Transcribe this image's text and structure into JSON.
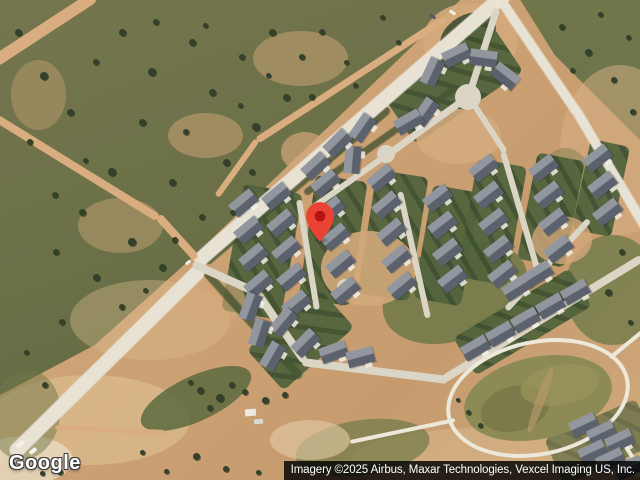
{
  "map": {
    "logo_text": "Google",
    "attribution_text": "Imagery ©2025 Airbus, Maxar Technologies, Vexcel Imaging US, Inc.",
    "pin": {
      "x": 320,
      "y": 242,
      "fill": "#EA4335",
      "dot": "#B31412"
    }
  },
  "palette": {
    "dirt": "#cda376",
    "dirt_light": "#e0bb8e",
    "trail": "#d9ad7f",
    "pale": "#e9dcc2",
    "road": "#e7e2d4",
    "street": "#dbd5c5",
    "path": "#ece8da",
    "scrub": "#6b7047",
    "lawn_a": "#52643c",
    "lawn_b": "#3e5030",
    "hedge": "#455532",
    "roof_dark": "#5b616d",
    "roof_light": "#92979f",
    "pond": "#8c8b56",
    "pond_dark": "#7b7a4a"
  },
  "scene": {
    "base_blobs": [
      {
        "cx": 90,
        "cy": 420,
        "w": 200,
        "h": 90,
        "c": "#e2c496",
        "op": 0.55
      },
      {
        "cx": 500,
        "cy": 462,
        "w": 300,
        "h": 70,
        "c": "#d8b78c",
        "op": 0.5
      },
      {
        "cx": 620,
        "cy": 150,
        "w": 120,
        "h": 170,
        "c": "#dab287",
        "op": 0.5
      },
      {
        "cx": 150,
        "cy": 320,
        "w": 160,
        "h": 80,
        "c": "#d9b88c",
        "op": 0.4
      },
      {
        "cx": 25,
        "cy": 460,
        "w": 95,
        "h": 48,
        "c": "#e9dcc2",
        "op": 0.8
      },
      {
        "cx": 470,
        "cy": 40,
        "w": 95,
        "h": 75,
        "c": "#d4aa7c",
        "op": 0.9
      }
    ],
    "green_mottle": [
      {
        "cx": 300,
        "cy": 58,
        "w": 95,
        "h": 55,
        "c": "#cfa678",
        "op": 0.5
      },
      {
        "cx": 205,
        "cy": 135,
        "w": 75,
        "h": 45,
        "c": "#cfa678",
        "op": 0.5
      },
      {
        "cx": 120,
        "cy": 225,
        "w": 85,
        "h": 55,
        "c": "#cfa678",
        "op": 0.45
      },
      {
        "cx": 38,
        "cy": 95,
        "w": 55,
        "h": 70,
        "c": "#cfa678",
        "op": 0.4
      }
    ],
    "green_blobs": [
      {
        "cx": 455,
        "cy": 292,
        "w": 150,
        "h": 95,
        "rot": -20,
        "c": "#6d7847",
        "op": 0.85
      },
      {
        "cx": 612,
        "cy": 290,
        "w": 95,
        "h": 110,
        "c": "#6f7a4a",
        "op": 0.8
      },
      {
        "cx": 362,
        "cy": 447,
        "w": 135,
        "h": 55,
        "rot": -8,
        "c": "#757c4c",
        "op": 0.75
      },
      {
        "cx": 196,
        "cy": 398,
        "w": 120,
        "h": 45,
        "rot": -25,
        "c": "#5c6a3e",
        "op": 0.85
      },
      {
        "cx": 25,
        "cy": 415,
        "w": 70,
        "h": 90,
        "rot": 10,
        "c": "#6f7749",
        "op": 0.5
      },
      {
        "cx": 565,
        "cy": 185,
        "w": 55,
        "h": 75,
        "c": "#767c4e",
        "op": 0.45
      },
      {
        "cx": 468,
        "cy": 35,
        "w": 60,
        "h": 40,
        "rot": -30,
        "c": "#3f4f31",
        "op": 0.9
      }
    ],
    "sub_dirt": [
      {
        "cx": 368,
        "cy": 268,
        "w": 95,
        "h": 75,
        "c": "#d2a87a",
        "op": 0.9
      },
      {
        "cx": 458,
        "cy": 136,
        "w": 85,
        "h": 55,
        "c": "#d5ac7e",
        "op": 0.85
      },
      {
        "cx": 562,
        "cy": 240,
        "w": 60,
        "h": 48,
        "c": "#d2a87a",
        "op": 0.8
      },
      {
        "cx": 305,
        "cy": 152,
        "w": 48,
        "h": 40,
        "c": "#d2a87a",
        "op": 0.7
      },
      {
        "cx": 210,
        "cy": 300,
        "w": 70,
        "h": 50,
        "c": "#d2a87a",
        "op": 0.6
      },
      {
        "cx": 310,
        "cy": 440,
        "w": 80,
        "h": 40,
        "c": "#e3cba6",
        "op": 0.6
      }
    ],
    "lawns": [
      {
        "cx": 262,
        "cy": 252,
        "w": 60,
        "h": 128,
        "rot": 10
      },
      {
        "cx": 333,
        "cy": 240,
        "w": 52,
        "h": 125,
        "rot": 8
      },
      {
        "cx": 393,
        "cy": 235,
        "w": 52,
        "h": 125,
        "rot": 9
      },
      {
        "cx": 447,
        "cy": 245,
        "w": 48,
        "h": 115,
        "rot": 10
      },
      {
        "cx": 492,
        "cy": 222,
        "w": 50,
        "h": 120,
        "rot": 10
      },
      {
        "cx": 551,
        "cy": 210,
        "w": 48,
        "h": 108,
        "rot": 11
      },
      {
        "cx": 601,
        "cy": 188,
        "w": 40,
        "h": 92,
        "rot": 12
      },
      {
        "cx": 522,
        "cy": 322,
        "w": 135,
        "h": 44,
        "rot": -31
      },
      {
        "cx": 300,
        "cy": 338,
        "w": 95,
        "h": 55,
        "rot": -42
      },
      {
        "cx": 452,
        "cy": 82,
        "w": 130,
        "h": 62,
        "rot": -34
      },
      {
        "cx": 600,
        "cy": 442,
        "w": 100,
        "h": 50,
        "rot": -24,
        "op": 0.65
      }
    ],
    "hedges": [
      {
        "cx": 297,
        "cy": 185,
        "len": 240,
        "w": 9,
        "rot": -40
      },
      {
        "cx": 252,
        "cy": 324,
        "len": 145,
        "w": 8,
        "rot": 48
      },
      {
        "cx": 380,
        "cy": 140,
        "len": 185,
        "w": 7,
        "rot": -35
      }
    ],
    "roads": [
      {
        "x1": 196,
        "y1": 263,
        "x2": 510,
        "y2": -10,
        "w": 14,
        "t": "road"
      },
      {
        "x1": 12,
        "y1": 455,
        "x2": 202,
        "y2": 268,
        "w": 14,
        "t": "road"
      },
      {
        "x1": 497,
        "y1": -6,
        "x2": 577,
        "y2": 112,
        "w": 9,
        "t": "road"
      },
      {
        "x1": 575,
        "y1": 108,
        "x2": 646,
        "y2": 228,
        "w": 9,
        "t": "road"
      },
      {
        "x1": 193,
        "y1": 264,
        "x2": 258,
        "y2": 293,
        "w": 8,
        "t": "street"
      },
      {
        "x1": 256,
        "y1": 291,
        "x2": 305,
        "y2": 362,
        "w": 8,
        "t": "street"
      },
      {
        "x1": 302,
        "y1": 362,
        "x2": 448,
        "y2": 380,
        "w": 8,
        "t": "street"
      },
      {
        "x1": 444,
        "y1": 379,
        "x2": 642,
        "y2": 258,
        "w": 8,
        "t": "street"
      },
      {
        "x1": 299,
        "y1": 200,
        "x2": 317,
        "y2": 310,
        "w": 6,
        "t": "street"
      },
      {
        "x1": 400,
        "y1": 192,
        "x2": 428,
        "y2": 318,
        "w": 6,
        "t": "street"
      },
      {
        "x1": 503,
        "y1": 152,
        "x2": 541,
        "y2": 282,
        "w": 6,
        "t": "street"
      },
      {
        "x1": 589,
        "y1": 220,
        "x2": 506,
        "y2": 310,
        "w": 6,
        "t": "street"
      },
      {
        "x1": 388,
        "y1": 154,
        "x2": 467,
        "y2": 97,
        "w": 7,
        "t": "street"
      },
      {
        "x1": 497,
        "y1": 8,
        "x2": 469,
        "y2": 95,
        "w": 7,
        "t": "street"
      },
      {
        "x1": 312,
        "y1": 208,
        "x2": 388,
        "y2": 154,
        "w": 6,
        "t": "street"
      },
      {
        "x1": 469,
        "y1": 97,
        "x2": 505,
        "y2": 152,
        "w": 6,
        "t": "street"
      },
      {
        "x1": 95,
        "y1": -4,
        "x2": -6,
        "y2": 62,
        "w": 12,
        "t": "trail"
      },
      {
        "x1": -4,
        "y1": 118,
        "x2": 158,
        "y2": 218,
        "w": 8,
        "t": "trail"
      },
      {
        "x1": 158,
        "y1": 216,
        "x2": 196,
        "y2": 258,
        "w": 8,
        "t": "trail"
      },
      {
        "x1": 445,
        "y1": 18,
        "x2": 257,
        "y2": 140,
        "w": 7,
        "t": "trail"
      },
      {
        "x1": 257,
        "y1": 140,
        "x2": 217,
        "y2": 196,
        "w": 6,
        "t": "trail"
      },
      {
        "x1": 55,
        "y1": 427,
        "x2": 165,
        "y2": 432,
        "w": 5,
        "t": "trail"
      },
      {
        "x1": 610,
        "y1": 358,
        "x2": 643,
        "y2": 331,
        "w": 4,
        "t": "path"
      },
      {
        "x1": 455,
        "y1": 420,
        "x2": 350,
        "y2": 442,
        "w": 4,
        "t": "path"
      },
      {
        "x1": 620,
        "y1": 438,
        "x2": 641,
        "y2": 470,
        "w": 4,
        "t": "path"
      }
    ],
    "culdesacs": [
      {
        "cx": 468,
        "cy": 97,
        "r": 13
      },
      {
        "cx": 386,
        "cy": 154,
        "r": 9
      },
      {
        "cx": 345,
        "cy": 287,
        "r": 8
      }
    ],
    "pond": {
      "loop": {
        "cx": 538,
        "cy": 398,
        "w": 186,
        "h": 116,
        "rot": -12
      },
      "body": [
        {
          "cx": 538,
          "cy": 398,
          "w": 150,
          "h": 82,
          "rot": -12,
          "c": "#8c8b56",
          "op": 1
        },
        {
          "cx": 515,
          "cy": 408,
          "w": 70,
          "h": 45,
          "rot": -15,
          "c": "#7b7a4a",
          "op": 1
        },
        {
          "cx": 560,
          "cy": 385,
          "w": 80,
          "h": 40,
          "rot": -10,
          "c": "#999259",
          "op": 0.8
        },
        {
          "cx": 540,
          "cy": 400,
          "w": 9,
          "h": 70,
          "rot": 20,
          "c": "#b89a6a",
          "op": 0.65
        }
      ]
    },
    "houses": [
      [
        243,
        203,
        -40
      ],
      [
        248,
        230,
        -40
      ],
      [
        253,
        257,
        -40
      ],
      [
        258,
        284,
        -40
      ],
      [
        276,
        196,
        -40
      ],
      [
        281,
        223,
        -40
      ],
      [
        286,
        250,
        -40
      ],
      [
        291,
        277,
        -40
      ],
      [
        296,
        304,
        -40
      ],
      [
        325,
        183,
        -40
      ],
      [
        330,
        210,
        -40
      ],
      [
        335,
        237,
        -40
      ],
      [
        340,
        264,
        -40
      ],
      [
        345,
        291,
        -40
      ],
      [
        381,
        178,
        -40
      ],
      [
        386,
        205,
        -40
      ],
      [
        391,
        232,
        -40
      ],
      [
        396,
        259,
        -40
      ],
      [
        401,
        286,
        -40
      ],
      [
        437,
        198,
        -38
      ],
      [
        442,
        225,
        -38
      ],
      [
        447,
        252,
        -38
      ],
      [
        452,
        279,
        -38
      ],
      [
        483,
        168,
        -38
      ],
      [
        488,
        195,
        -38
      ],
      [
        493,
        222,
        -38
      ],
      [
        498,
        249,
        -38
      ],
      [
        502,
        274,
        -38
      ],
      [
        543,
        168,
        -38
      ],
      [
        548,
        195,
        -38
      ],
      [
        553,
        222,
        -38
      ],
      [
        558,
        249,
        -38
      ],
      [
        597,
        158,
        -38
      ],
      [
        602,
        185,
        -38
      ],
      [
        607,
        212,
        -38
      ],
      [
        475,
        348,
        -30
      ],
      [
        500,
        334,
        -30
      ],
      [
        525,
        320,
        -30
      ],
      [
        550,
        306,
        -30
      ],
      [
        575,
        292,
        -30
      ],
      [
        283,
        322,
        -50
      ],
      [
        305,
        343,
        -45
      ],
      [
        333,
        352,
        -20
      ],
      [
        360,
        357,
        -15
      ],
      [
        250,
        307,
        -70
      ],
      [
        259,
        333,
        -72
      ],
      [
        272,
        356,
        -60
      ],
      [
        432,
        72,
        -65
      ],
      [
        456,
        55,
        -25
      ],
      [
        483,
        58,
        8
      ],
      [
        505,
        76,
        38
      ],
      [
        425,
        112,
        -55
      ],
      [
        362,
        128,
        -55
      ],
      [
        352,
        160,
        -85
      ],
      [
        408,
        122,
        -30
      ],
      [
        337,
        143,
        -45
      ],
      [
        315,
        166,
        -43
      ],
      [
        516,
        288,
        -32
      ],
      [
        538,
        274,
        -32
      ],
      [
        583,
        425,
        -25
      ],
      [
        601,
        433,
        -25
      ],
      [
        619,
        441,
        -25
      ],
      [
        592,
        452,
        -25
      ],
      [
        610,
        460,
        -25
      ],
      [
        628,
        468,
        -25
      ]
    ],
    "trees": [
      [
        18,
        32,
        7
      ],
      [
        44,
        76,
        8
      ],
      [
        30,
        142,
        6
      ],
      [
        70,
        112,
        7
      ],
      [
        96,
        62,
        6
      ],
      [
        122,
        32,
        7
      ],
      [
        152,
        72,
        8
      ],
      [
        142,
        122,
        7
      ],
      [
        112,
        172,
        8
      ],
      [
        82,
        212,
        7
      ],
      [
        56,
        252,
        6
      ],
      [
        96,
        277,
        7
      ],
      [
        132,
        242,
        8
      ],
      [
        172,
        182,
        7
      ],
      [
        186,
        132,
        6
      ],
      [
        212,
        92,
        7
      ],
      [
        242,
        57,
        6
      ],
      [
        272,
        32,
        7
      ],
      [
        302,
        57,
        6
      ],
      [
        286,
        97,
        7
      ],
      [
        256,
        127,
        8
      ],
      [
        226,
        162,
        7
      ],
      [
        202,
        217,
        6
      ],
      [
        162,
        267,
        7
      ],
      [
        122,
        307,
        6
      ],
      [
        62,
        322,
        6
      ],
      [
        26,
        352,
        5
      ],
      [
        156,
        22,
        6
      ],
      [
        192,
        42,
        7
      ],
      [
        322,
        32,
        6
      ],
      [
        346,
        62,
        5
      ],
      [
        312,
        97,
        6
      ],
      [
        232,
        212,
        5
      ],
      [
        252,
        172,
        6
      ],
      [
        355,
        85,
        5
      ],
      [
        382,
        17,
        5
      ],
      [
        398,
        42,
        5
      ],
      [
        175,
        240,
        6
      ],
      [
        145,
        290,
        5
      ],
      [
        85,
        160,
        5
      ],
      [
        55,
        195,
        6
      ],
      [
        240,
        105,
        5
      ],
      [
        205,
        25,
        5
      ],
      [
        268,
        75,
        5
      ],
      [
        45,
        385,
        6
      ],
      [
        562,
        27,
        6
      ],
      [
        588,
        52,
        7
      ],
      [
        614,
        80,
        6
      ],
      [
        628,
        37,
        5
      ],
      [
        600,
        14,
        5
      ],
      [
        633,
        112,
        6
      ],
      [
        572,
        70,
        5
      ],
      [
        622,
        252,
        6
      ],
      [
        608,
        292,
        7
      ],
      [
        630,
        322,
        5
      ],
      [
        196,
        456,
        7
      ],
      [
        226,
        469,
        6
      ],
      [
        166,
        471,
        5
      ],
      [
        12,
        463,
        5
      ],
      [
        42,
        473,
        5
      ],
      [
        142,
        452,
        5
      ],
      [
        258,
        472,
        5
      ],
      [
        60,
        472,
        6
      ],
      [
        200,
        390,
        7
      ],
      [
        220,
        398,
        8
      ],
      [
        245,
        392,
        6
      ],
      [
        265,
        400,
        7
      ],
      [
        285,
        395,
        6
      ],
      [
        232,
        385,
        6
      ],
      [
        210,
        408,
        6
      ],
      [
        190,
        382,
        5
      ],
      [
        468,
        412,
        5
      ],
      [
        480,
        425,
        5
      ],
      [
        458,
        400,
        4
      ]
    ],
    "specks": [
      [
        20,
        444,
        9,
        4,
        -40,
        "#f5f2ea"
      ],
      [
        33,
        451,
        8,
        4,
        -40,
        "#f5f2ea"
      ],
      [
        250,
        412,
        11,
        7,
        -5,
        "#eceae2"
      ],
      [
        258,
        421,
        9,
        5,
        -5,
        "#dcd9ce"
      ],
      [
        432,
        16,
        7,
        3,
        32,
        "#555a60"
      ],
      [
        452,
        12,
        7,
        3,
        32,
        "#f2efe6"
      ],
      [
        188,
        262,
        6,
        3,
        -40,
        "#f2efe6"
      ]
    ]
  }
}
